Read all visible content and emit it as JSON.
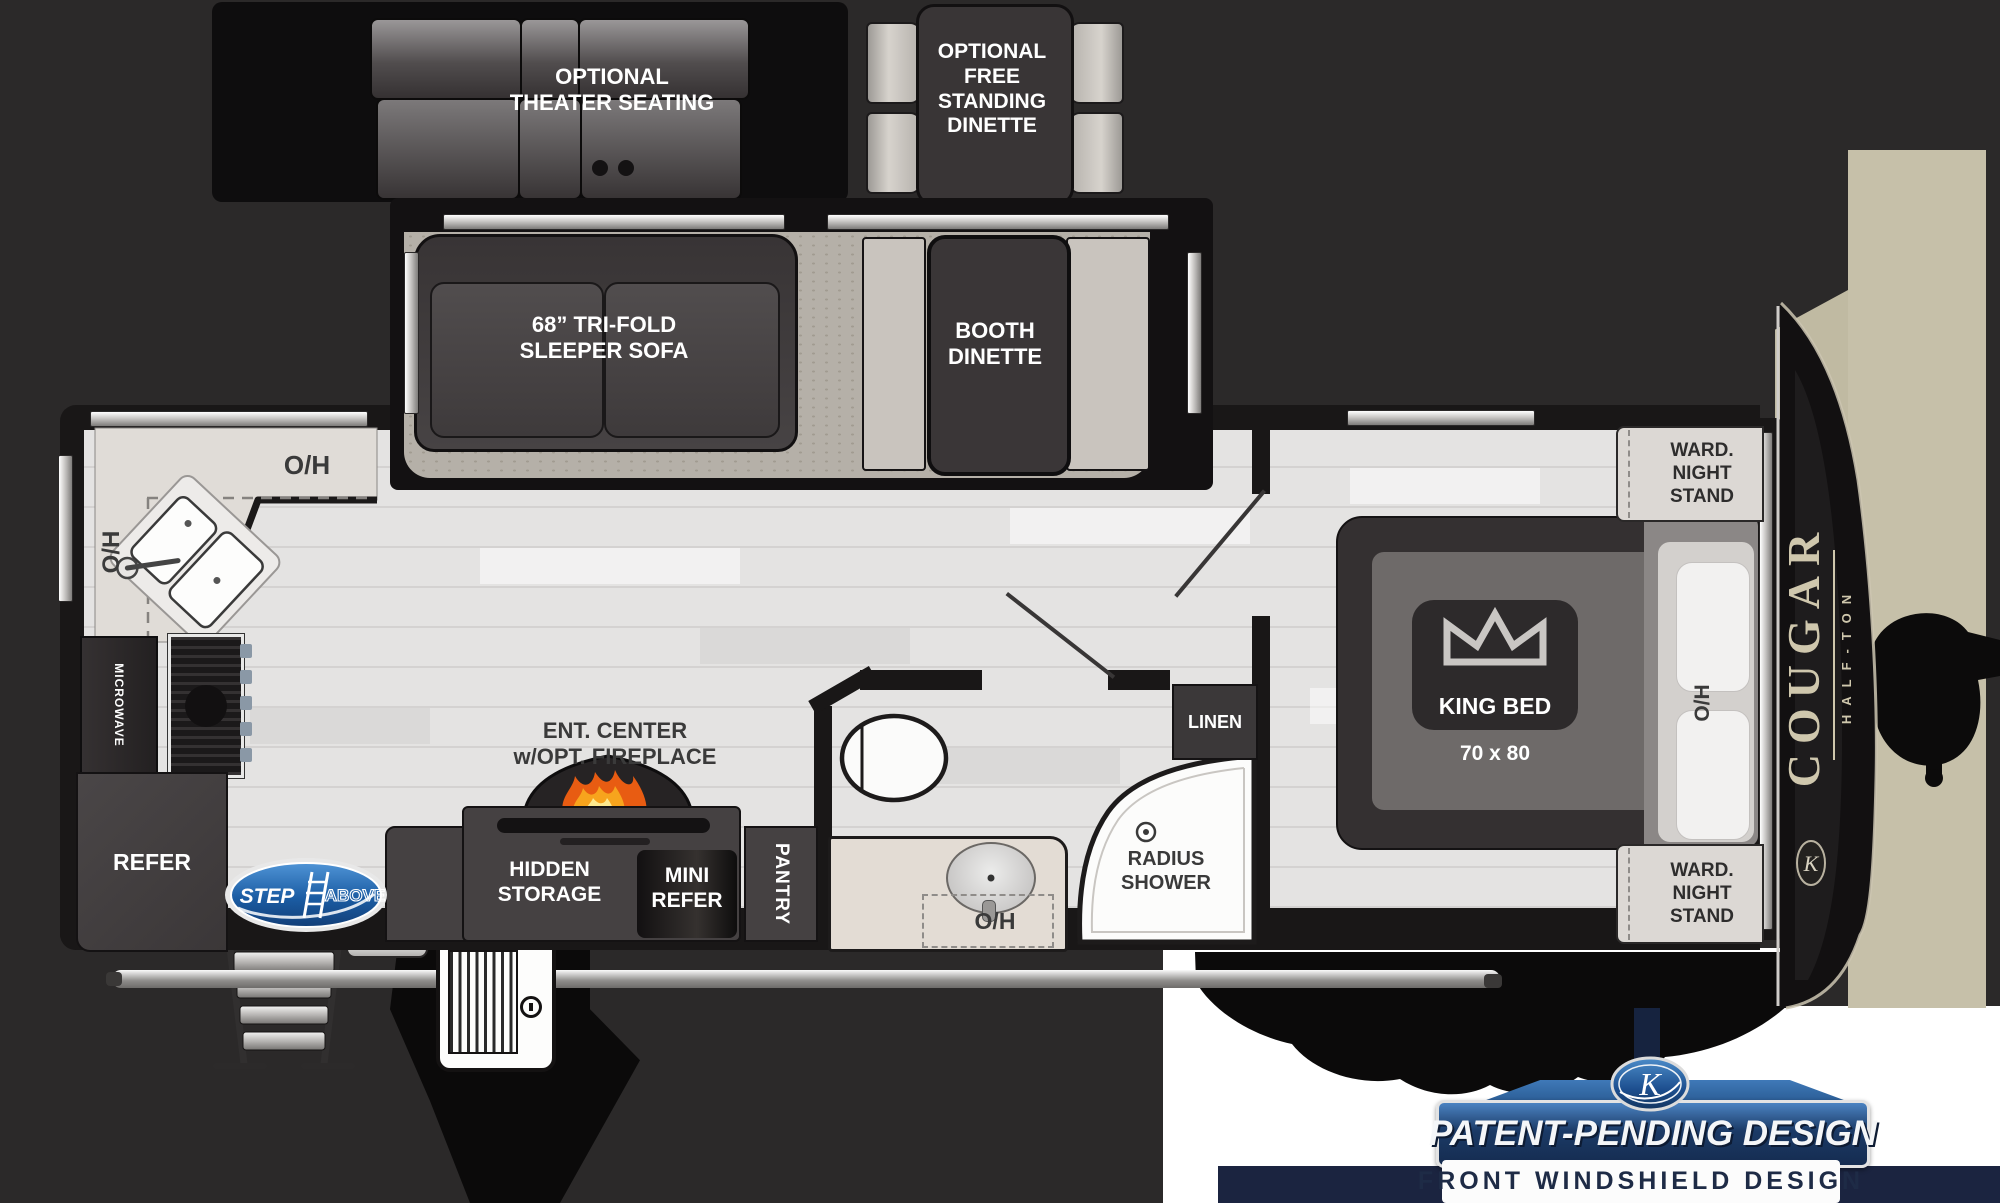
{
  "title": "Cougar Half-Ton travel trailer floor plan",
  "colors": {
    "background": "#2b2929",
    "floor": "#e4e3e2",
    "carpet": "#b5b0a8",
    "wall": "#191717",
    "furniture_dark": "#454142",
    "seat_light": "#c9c4be",
    "counter": "#e0dcd7",
    "windshield_beige": "#c6c0a9",
    "banner_navy": "#1b2440",
    "banner_blue": "#2f66a4",
    "step_logo_blue": "#1b5ca3",
    "flame_orange": "#f07818"
  },
  "optional": {
    "theater": "OPTIONAL\nTHEATER SEATING",
    "dinette": "OPTIONAL\nFREE\nSTANDING\nDINETTE"
  },
  "living": {
    "sofa": "68” TRI-FOLD\nSLEEPER SOFA",
    "booth": "BOOTH\nDINETTE",
    "ent_center": "ENT. CENTER\nw/OPT. FIREPLACE",
    "hidden_storage": "HIDDEN\nSTORAGE",
    "mini_refer": "MINI\nREFER",
    "pantry": "PANTRY"
  },
  "kitchen": {
    "overhead_top": "O/H",
    "overhead_left": "O/H",
    "microwave": "MICROWAVE",
    "refer": "REFER"
  },
  "bath": {
    "overhead": "O/H",
    "shower": "RADIUS\nSHOWER",
    "linen": "LINEN"
  },
  "bedroom": {
    "king_bed": "KING BED",
    "bed_size": "70 x 80",
    "overhead": "O/H",
    "wardrobe_top": "WARD.\nNIGHT\nSTAND",
    "wardrobe_bottom": "WARD.\nNIGHT\nSTAND"
  },
  "branding": {
    "model": "COUGAR",
    "trim": "HALF-TON",
    "step_above_word1": "STEP",
    "step_above_word2": "ABOVE",
    "patent_banner": "PATENT-PENDING DESIGN",
    "windshield_banner": "FRONT WINDSHIELD DESIGN"
  }
}
